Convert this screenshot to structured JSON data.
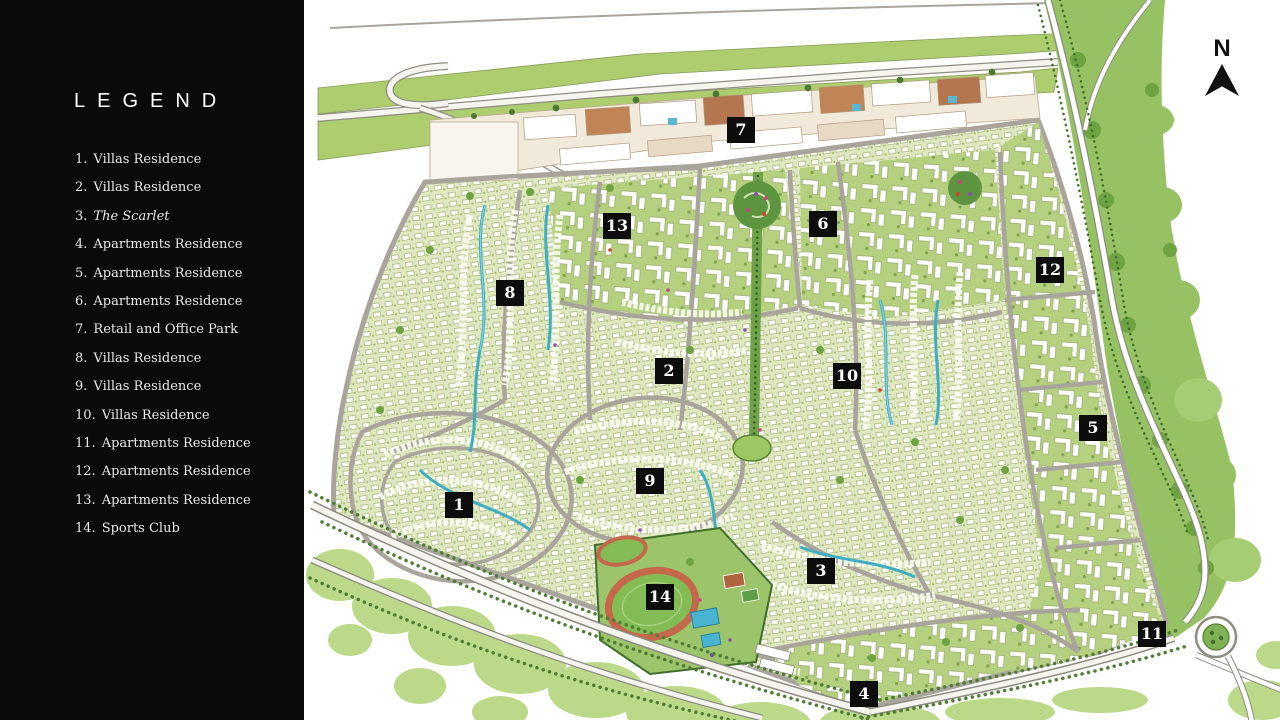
{
  "legend": {
    "title": "LEGEND",
    "items": [
      {
        "num": "1.",
        "label": "Villas Residence",
        "italic": false
      },
      {
        "num": "2.",
        "label": "Villas Residence",
        "italic": false
      },
      {
        "num": "3.",
        "label": "The Scarlet",
        "italic": true
      },
      {
        "num": "4.",
        "label": "Apartments Residence",
        "italic": false
      },
      {
        "num": "5.",
        "label": "Apartments Residence",
        "italic": false
      },
      {
        "num": "6.",
        "label": "Apartments Residence",
        "italic": false
      },
      {
        "num": "7.",
        "label": "Retail and Office Park",
        "italic": false
      },
      {
        "num": "8.",
        "label": "Villas Residence",
        "italic": false
      },
      {
        "num": "9.",
        "label": "Villas Residence",
        "italic": false
      },
      {
        "num": "10.",
        "label": "Villas Residence",
        "italic": false
      },
      {
        "num": "11.",
        "label": "Apartments Residence",
        "italic": false
      },
      {
        "num": "12.",
        "label": "Apartments Residence",
        "italic": false
      },
      {
        "num": "13.",
        "label": "Apartments Residence",
        "italic": false
      },
      {
        "num": "14.",
        "label": "Sports Club",
        "italic": false
      }
    ]
  },
  "map": {
    "north_label": "N",
    "markers": [
      {
        "label": "1",
        "x": 155,
        "y": 505
      },
      {
        "label": "2",
        "x": 365,
        "y": 371
      },
      {
        "label": "3",
        "x": 517,
        "y": 571
      },
      {
        "label": "4",
        "x": 560,
        "y": 694
      },
      {
        "label": "5",
        "x": 789,
        "y": 428
      },
      {
        "label": "6",
        "x": 519,
        "y": 224
      },
      {
        "label": "7",
        "x": 437,
        "y": 130
      },
      {
        "label": "8",
        "x": 206,
        "y": 293
      },
      {
        "label": "9",
        "x": 346,
        "y": 481
      },
      {
        "label": "10",
        "x": 543,
        "y": 376
      },
      {
        "label": "11",
        "x": 848,
        "y": 634
      },
      {
        "label": "12",
        "x": 746,
        "y": 270
      },
      {
        "label": "13",
        "x": 313,
        "y": 226
      },
      {
        "label": "14",
        "x": 356,
        "y": 597
      }
    ]
  },
  "colors": {
    "sidebar_bg": "#0a0a0a",
    "legend_text": "#e9e9e9",
    "marker_bg": "#0d0d0d",
    "marker_text": "#ffffff",
    "band_green": "#aecd6e",
    "corridor_green": "#96c263",
    "pale_green": "#bcd98a",
    "villa_base": "#dfe8c1",
    "apartment_green": "#b5d07e",
    "road_gray": "#a9a59d",
    "water_teal": "#3fadc2",
    "track_orange": "#c4674a",
    "retail_terracotta": "#b3764f"
  }
}
